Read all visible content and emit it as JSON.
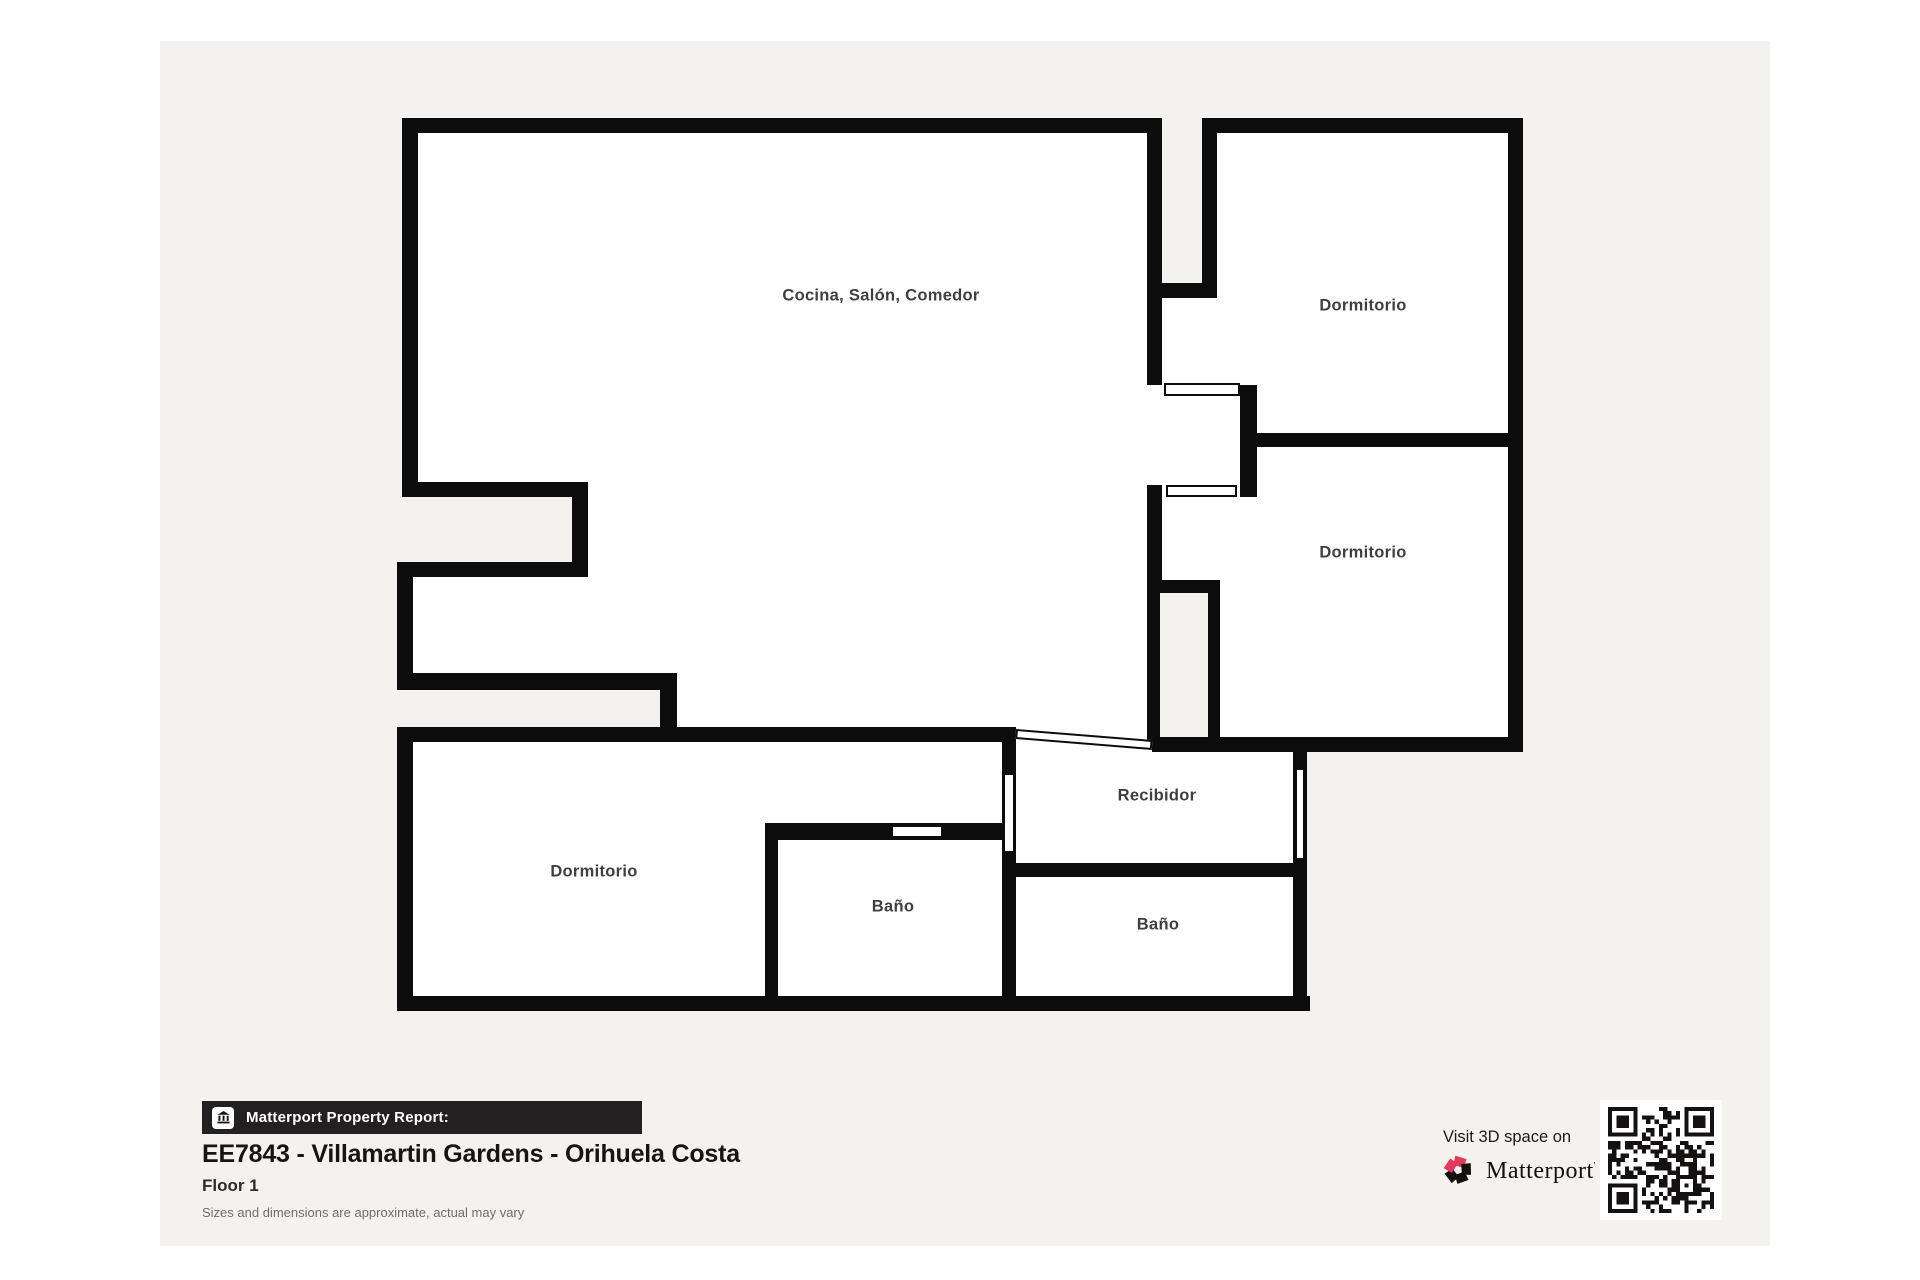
{
  "plan": {
    "rooms": {
      "living": "Cocina, Salón, Comedor",
      "bedroom_top_right": "Dormitorio",
      "bedroom_mid_right": "Dormitorio",
      "bedroom_bottom_left": "Dormitorio",
      "entry_hall": "Recibidor",
      "bath_left": "Baño",
      "bath_right": "Baño"
    }
  },
  "footer": {
    "report_label": "Matterport Property Report:",
    "property_title": "EE7843 - Villamartin Gardens - Orihuela Costa",
    "floor_label": "Floor 1",
    "disclaimer": "Sizes and dimensions are approximate, actual may vary"
  },
  "cta": {
    "visit_text": "Visit 3D space on",
    "brand": "Matterport",
    "brand_mark": "'"
  },
  "colors": {
    "wall": "#0d0c0c",
    "sheet": "#f4f2ef",
    "bar": "#242021",
    "label": "#3f3f3f",
    "accent_pink": "#e23a5c"
  }
}
